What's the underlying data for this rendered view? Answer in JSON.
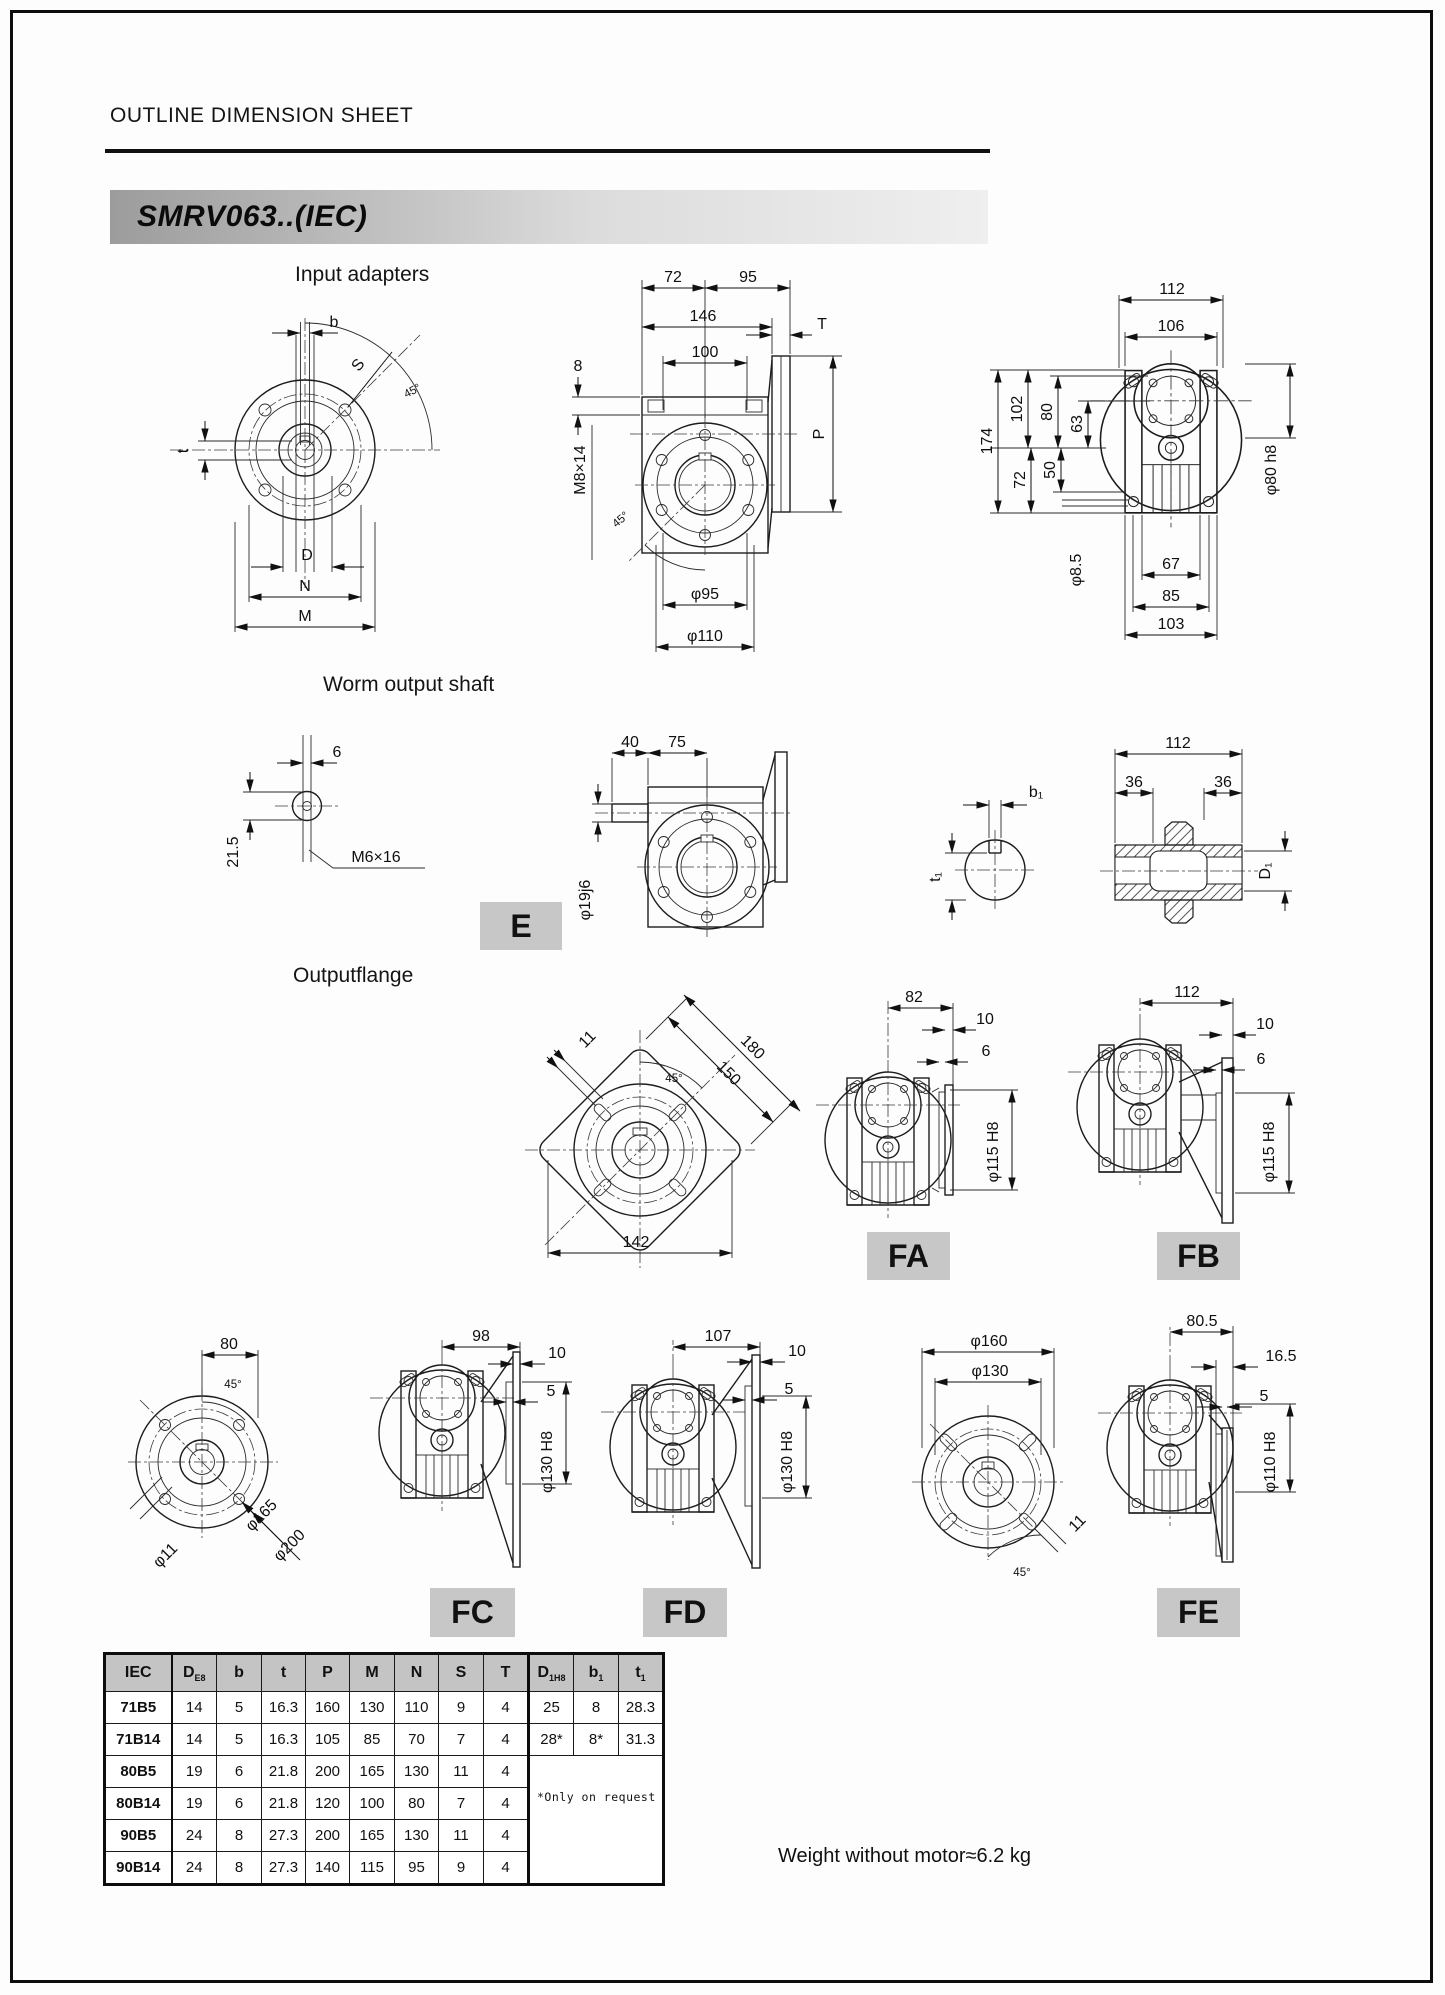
{
  "page": {
    "title": "OUTLINE DIMENSION SHEET",
    "model": "SMRV063..(IEC)",
    "weight_note": "Weight without motor≈6.2 kg"
  },
  "sections": {
    "input_adapters": "Input adapters",
    "worm_output_shaft": "Worm output shaft",
    "output_flange": "Outputflange"
  },
  "badges": {
    "e": "E",
    "fa": "FA",
    "fb": "FB",
    "fc": "FC",
    "fd": "FD",
    "fe": "FE"
  },
  "dims": {
    "il": {
      "b": "b",
      "S": "S",
      "a45": "45°",
      "t": "t",
      "D": "D",
      "N": "N",
      "M": "M"
    },
    "im": {
      "k72": "72",
      "k95": "95",
      "k146": "146",
      "k100": "100",
      "T": "T",
      "k8": "8",
      "P": "P",
      "m8": "M8×14",
      "a45": "45°",
      "p95": "φ95",
      "p110": "φ110"
    },
    "ir": {
      "k112": "112",
      "k106": "106",
      "k174": "174",
      "k102": "102",
      "k80": "80",
      "k63": "63",
      "k72": "72",
      "k50": "50",
      "p85": "φ8.5",
      "k67": "67",
      "k85": "85",
      "k103": "103",
      "p80": "φ80 h8"
    },
    "wl": {
      "k6": "6",
      "k215": "21.5",
      "m6": "M6×16"
    },
    "wm": {
      "k40": "40",
      "k75": "75",
      "p19": "φ19j6"
    },
    "wr": {
      "b1": "b₁",
      "t1": "t₁",
      "k112": "112",
      "k36a": "36",
      "k36b": "36",
      "D1": "D₁"
    },
    "sq": {
      "k11": "11",
      "a45": "45°",
      "k180": "180",
      "k150": "150",
      "k142": "142"
    },
    "fa": {
      "k82": "82",
      "k10": "10",
      "k6": "6",
      "p115": "φ115 H8"
    },
    "fb": {
      "k112": "112",
      "k10": "10",
      "k6": "6",
      "p115": "φ115 H8"
    },
    "cl": {
      "k80": "80",
      "a45": "45°",
      "p11": "φ11",
      "p165": "φ165",
      "p200": "φ200"
    },
    "fc": {
      "k98": "98",
      "k10": "10",
      "k5": "5",
      "p130": "φ130 H8"
    },
    "fd": {
      "k107": "107",
      "k10": "10",
      "k5": "5",
      "p130": "φ130 H8"
    },
    "fel": {
      "p160": "φ160",
      "p130": "φ130",
      "k11": "11",
      "a45": "45°"
    },
    "fe": {
      "k805": "80.5",
      "k165": "16.5",
      "k5": "5",
      "p110": "φ110 H8"
    }
  },
  "table": {
    "headers": [
      {
        "main": "IEC",
        "sub": ""
      },
      {
        "main": "D",
        "sub": "E8"
      },
      {
        "main": "b",
        "sub": ""
      },
      {
        "main": "t",
        "sub": ""
      },
      {
        "main": "P",
        "sub": ""
      },
      {
        "main": "M",
        "sub": ""
      },
      {
        "main": "N",
        "sub": ""
      },
      {
        "main": "S",
        "sub": ""
      },
      {
        "main": "T",
        "sub": ""
      },
      {
        "main": "D",
        "sub": "1H8"
      },
      {
        "main": "b",
        "sub": "1"
      },
      {
        "main": "t",
        "sub": "1"
      }
    ],
    "rows": [
      [
        "71B5",
        "14",
        "5",
        "16.3",
        "160",
        "130",
        "110",
        "9",
        "4",
        "25",
        "8",
        "28.3"
      ],
      [
        "71B14",
        "14",
        "5",
        "16.3",
        "105",
        "85",
        "70",
        "7",
        "4",
        "28*",
        "8*",
        "31.3"
      ],
      [
        "80B5",
        "19",
        "6",
        "21.8",
        "200",
        "165",
        "130",
        "11",
        "4"
      ],
      [
        "80B14",
        "19",
        "6",
        "21.8",
        "120",
        "100",
        "80",
        "7",
        "4"
      ],
      [
        "90B5",
        "24",
        "8",
        "27.3",
        "200",
        "165",
        "130",
        "11",
        "4"
      ],
      [
        "90B14",
        "24",
        "8",
        "27.3",
        "140",
        "115",
        "95",
        "9",
        "4"
      ]
    ],
    "note": "*Only on request"
  }
}
